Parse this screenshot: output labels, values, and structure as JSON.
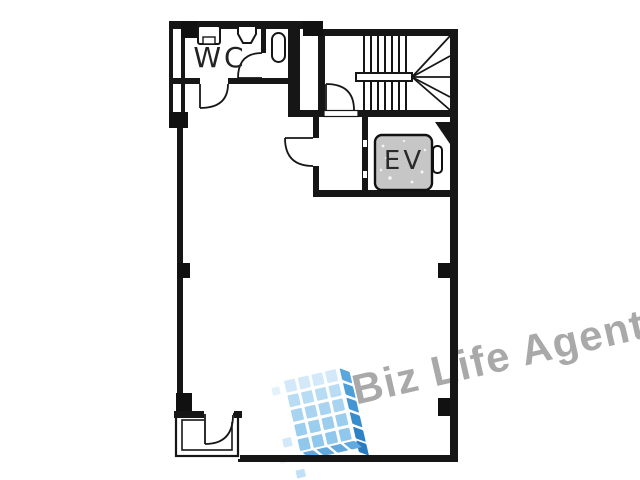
{
  "rooms": {
    "wc": {
      "label": "WC"
    },
    "elevator": {
      "label": "EV"
    }
  },
  "colors": {
    "background": "#ffffff",
    "wall": "#161616",
    "elevator_car_fill": "#c6c6c6",
    "watermark_text": "#a9a9a9"
  },
  "watermark": {
    "text": "Biz Life Agent",
    "logo": {
      "front_rows": [
        "#d3e9f9",
        "#b7dcf4",
        "#a8d4f1",
        "#9bcdee",
        "#90c7ec"
      ],
      "side_rows": [
        "#59a7dc",
        "#4d9fd8",
        "#4296d3",
        "#378ccd",
        "#2d82c6",
        "#2a7cc0"
      ],
      "bottom_color": "#62a9dd",
      "extra_tiles": [
        {
          "x": -14,
          "y": 4,
          "w": 8,
          "h": 8,
          "c": "#e3f1fb"
        },
        {
          "x": -15,
          "y": 56,
          "w": 9,
          "h": 9,
          "c": "#d3e9f9"
        },
        {
          "x": -22,
          "y": 73,
          "w": 7,
          "h": 7,
          "c": "#e8f4fc"
        },
        {
          "x": -9,
          "y": 90,
          "w": 9,
          "h": 8,
          "c": "#bfe0f6"
        }
      ]
    }
  }
}
